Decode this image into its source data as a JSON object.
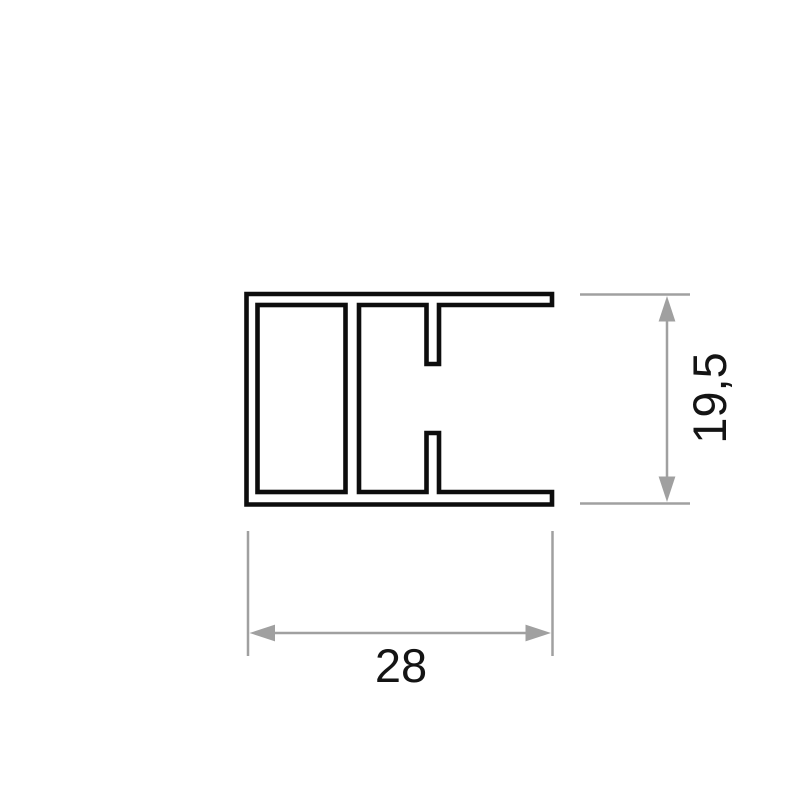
{
  "canvas": {
    "background_color": "#ffffff"
  },
  "profile": {
    "outline_color": "#0d0d0d"
  },
  "dimensions": {
    "line_color": "#a0a0a0",
    "text_color": "#141414",
    "width": {
      "label": "28"
    },
    "height": {
      "label": "19,5"
    }
  }
}
